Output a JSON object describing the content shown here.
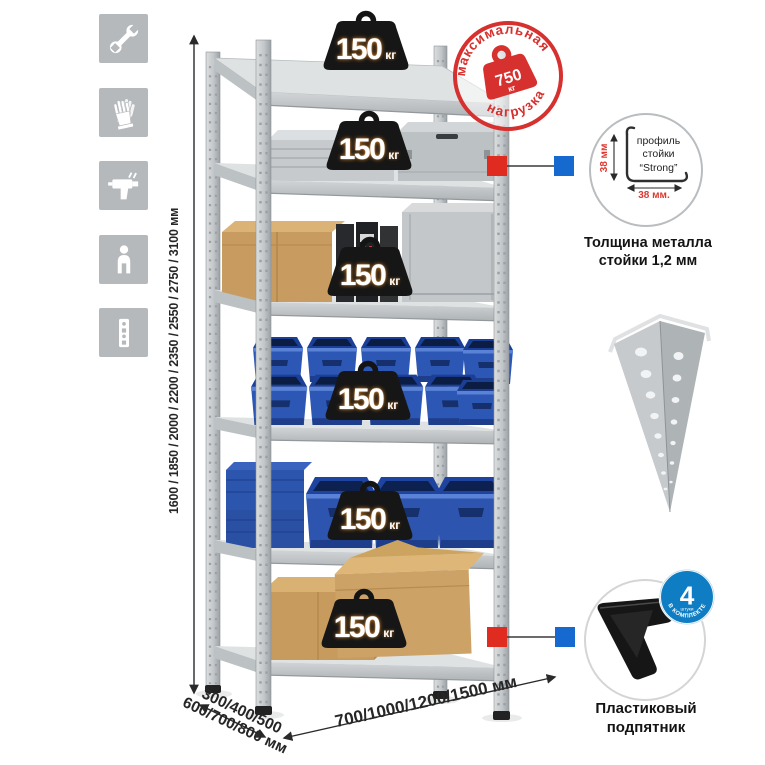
{
  "stamp": {
    "arc_top": "максимальная",
    "arc_bottom": "нагрузка",
    "value": "750",
    "unit": "кг"
  },
  "shelf_weights": [
    {
      "value": "150",
      "unit": "кг"
    },
    {
      "value": "150",
      "unit": "кг"
    },
    {
      "value": "150",
      "unit": "кг"
    },
    {
      "value": "150",
      "unit": "кг"
    },
    {
      "value": "150",
      "unit": "кг"
    },
    {
      "value": "150",
      "unit": "кг"
    }
  ],
  "dimensions": {
    "height": "1600 / 1850 / 2000 / 2200 / 2350 / 2550 / 2750 / 3100 мм",
    "depth_line1": "300/400/500",
    "depth_line2": "600/700/800 мм",
    "width": "700/1000/1200/1500 мм"
  },
  "profile_detail": {
    "label_line1": "профиль",
    "label_line2": "стойки",
    "label_line3": "“Strong”",
    "dim_height": "38 мм",
    "dim_width": "38 мм.",
    "caption_line1": "Толщина металла",
    "caption_line2": "стойки 1,2 мм"
  },
  "foot_detail": {
    "badge_count": "4",
    "badge_sub": "штуки",
    "badge_arc": "В КОМПЛЕКТЕ",
    "caption_line1": "Пластиковый",
    "caption_line2": "подпятник"
  },
  "icons": [
    {
      "name": "wrench-icon"
    },
    {
      "name": "gloves-icon"
    },
    {
      "name": "drill-icon"
    },
    {
      "name": "person-icon"
    },
    {
      "name": "upright-profile-icon"
    }
  ],
  "colors": {
    "stamp_red": "#d6312e",
    "dimension_red": "#e0372f",
    "marker_red": "#e02b20",
    "marker_blue": "#1569cf",
    "badge_blue": "#0f7dc4",
    "bin_blue": "#2d57b2",
    "icon_gray": "#b5b9bc"
  }
}
